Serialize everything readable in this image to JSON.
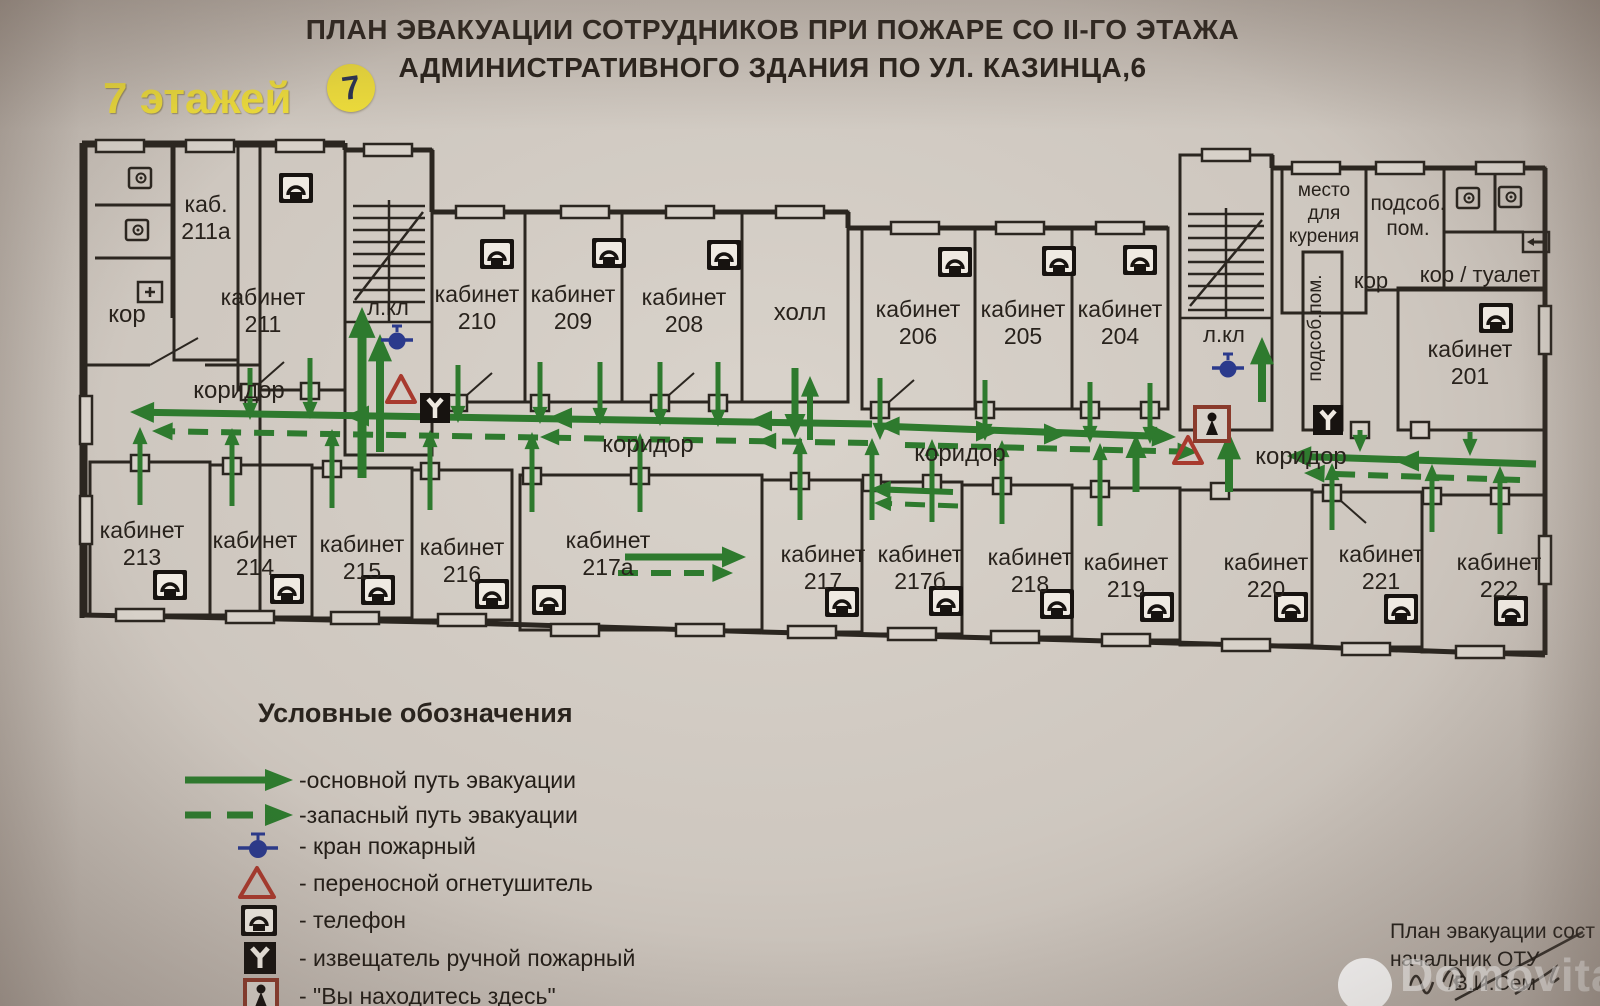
{
  "title": {
    "line1": "ПЛАН ЭВАКУАЦИИ СОТРУДНИКОВ  ПРИ ПОЖАРЕ СО II-ГО ЭТАЖА",
    "line2": "АДМИНИСТРАТИВНОГО ЗДАНИЯ ПО УЛ. КАЗИНЦА,6"
  },
  "floors": {
    "label": "7 этажей",
    "badge": "7"
  },
  "colors": {
    "wall": "#2b2620",
    "paper": "#d7d1c9",
    "green": "#2e7a2e",
    "red": "#a83a2e",
    "blue": "#2b3a8c",
    "black": "#171310",
    "here_box": "#8a3b2c",
    "yellow": "#f0df3a",
    "text": "#28221c"
  },
  "legend": {
    "title": "Условные обозначения",
    "items": [
      {
        "icon": "arrow-solid",
        "label": "-основной путь эвакуации"
      },
      {
        "icon": "arrow-dashed",
        "label": "-запасный путь эвакуации"
      },
      {
        "icon": "hydrant",
        "label": "- кран пожарный"
      },
      {
        "icon": "extinguisher",
        "label": "- переносной огнетушитель"
      },
      {
        "icon": "phone",
        "label": "- телефон"
      },
      {
        "icon": "alarm",
        "label": "- извещатель ручной пожарный"
      },
      {
        "icon": "you-are-here",
        "label": "- \"Вы находитесь здесь\""
      }
    ]
  },
  "footer": {
    "line1": "План эвакуации сост",
    "line2": "начальник ОТУ",
    "line3": "/В.И.Сем"
  },
  "watermark": {
    "text": "Domovita"
  },
  "plan": {
    "rooms": [
      [
        86,
        146,
        174,
        469
      ],
      [
        174,
        146,
        64,
        214
      ],
      [
        238,
        146,
        107,
        244
      ],
      [
        345,
        150,
        87,
        305
      ],
      [
        432,
        212,
        93,
        190
      ],
      [
        525,
        212,
        97,
        190
      ],
      [
        622,
        212,
        120,
        190
      ],
      [
        742,
        212,
        106,
        190
      ],
      [
        862,
        228,
        113,
        181
      ],
      [
        975,
        228,
        97,
        181
      ],
      [
        1072,
        228,
        96,
        181
      ],
      [
        1180,
        155,
        92,
        275
      ],
      [
        1282,
        168,
        84,
        145
      ],
      [
        1366,
        168,
        78,
        122
      ],
      [
        1303,
        252,
        39,
        178
      ],
      [
        1444,
        168,
        101,
        122
      ],
      [
        1398,
        288,
        147,
        142
      ],
      [
        90,
        462,
        120,
        153
      ],
      [
        210,
        465,
        102,
        152
      ],
      [
        312,
        468,
        100,
        150
      ],
      [
        412,
        470,
        100,
        150
      ],
      [
        520,
        475,
        242,
        155
      ],
      [
        762,
        480,
        100,
        152
      ],
      [
        862,
        482,
        100,
        152
      ],
      [
        962,
        485,
        110,
        152
      ],
      [
        1072,
        488,
        108,
        152
      ],
      [
        1180,
        490,
        132,
        155
      ],
      [
        1312,
        492,
        110,
        155
      ],
      [
        1422,
        495,
        123,
        157
      ]
    ],
    "outer": [
      [
        82,
        143,
        82,
        618
      ],
      [
        82,
        143,
        345,
        143
      ],
      [
        345,
        143,
        345,
        150
      ],
      [
        345,
        150,
        432,
        150
      ],
      [
        432,
        150,
        432,
        212
      ],
      [
        432,
        212,
        848,
        212
      ],
      [
        848,
        212,
        848,
        228
      ],
      [
        848,
        228,
        1168,
        228
      ],
      [
        1272,
        155,
        1272,
        168
      ],
      [
        1272,
        168,
        1282,
        168
      ],
      [
        1282,
        168,
        1545,
        168
      ],
      [
        1545,
        168,
        1545,
        655
      ],
      [
        82,
        615,
        432,
        622
      ],
      [
        432,
        622,
        762,
        632
      ],
      [
        762,
        632,
        1072,
        640
      ],
      [
        1072,
        640,
        1312,
        647
      ],
      [
        1312,
        647,
        1545,
        655
      ]
    ],
    "walls": [
      [
        95,
        205,
        172,
        205
      ],
      [
        95,
        258,
        172,
        258
      ],
      [
        172,
        146,
        172,
        318
      ],
      [
        86,
        365,
        150,
        365
      ],
      [
        205,
        365,
        260,
        365
      ],
      [
        1495,
        168,
        1495,
        232
      ],
      [
        1444,
        232,
        1524,
        232
      ],
      [
        150,
        365,
        198,
        338,
        2
      ],
      [
        250,
        392,
        284,
        362,
        2
      ],
      [
        458,
        403,
        492,
        373,
        2
      ],
      [
        660,
        403,
        694,
        373,
        2
      ],
      [
        880,
        410,
        914,
        380,
        2
      ],
      [
        1332,
        493,
        1366,
        523,
        2
      ]
    ],
    "stairs": [
      {
        "x1": 353,
        "x2": 425,
        "div": 389,
        "y": 206,
        "n": 8,
        "dy": 12,
        "diag": [
          355,
          300,
          423,
          212
        ],
        "divline": [
          389,
          200,
          389,
          322
        ],
        "land": [
          345,
          322,
          432,
          322
        ]
      },
      {
        "x1": 1188,
        "x2": 1264,
        "div": 1226,
        "y": 214,
        "n": 8,
        "dy": 12,
        "diag": [
          1190,
          306,
          1262,
          220
        ],
        "divline": [
          1226,
          208,
          1226,
          318
        ],
        "land": [
          1180,
          318,
          1272,
          318
        ]
      }
    ],
    "doors": [
      [
        250,
        392
      ],
      [
        310,
        391
      ],
      [
        458,
        403
      ],
      [
        540,
        403
      ],
      [
        660,
        403
      ],
      [
        718,
        403
      ],
      [
        880,
        410
      ],
      [
        985,
        410
      ],
      [
        1090,
        410
      ],
      [
        1150,
        410
      ],
      [
        140,
        463
      ],
      [
        232,
        466
      ],
      [
        332,
        469
      ],
      [
        430,
        471
      ],
      [
        532,
        476
      ],
      [
        640,
        476
      ],
      [
        800,
        481
      ],
      [
        872,
        483
      ],
      [
        932,
        483
      ],
      [
        1002,
        486
      ],
      [
        1100,
        489
      ],
      [
        1220,
        491
      ],
      [
        1332,
        493
      ],
      [
        1432,
        496
      ],
      [
        1500,
        496
      ],
      [
        1420,
        430
      ],
      [
        1360,
        430
      ]
    ],
    "bumps": [
      [
        120,
        146,
        "h"
      ],
      [
        210,
        146,
        "h"
      ],
      [
        300,
        146,
        "h"
      ],
      [
        388,
        150,
        "h"
      ],
      [
        480,
        212,
        "h"
      ],
      [
        585,
        212,
        "h"
      ],
      [
        690,
        212,
        "h"
      ],
      [
        800,
        212,
        "h"
      ],
      [
        915,
        228,
        "h"
      ],
      [
        1020,
        228,
        "h"
      ],
      [
        1120,
        228,
        "h"
      ],
      [
        1226,
        155,
        "h"
      ],
      [
        1316,
        168,
        "h"
      ],
      [
        1400,
        168,
        "h"
      ],
      [
        1500,
        168,
        "h"
      ],
      [
        140,
        615,
        "h"
      ],
      [
        250,
        617,
        "h"
      ],
      [
        355,
        618,
        "h"
      ],
      [
        462,
        620,
        "h"
      ],
      [
        575,
        630,
        "h"
      ],
      [
        700,
        630,
        "h"
      ],
      [
        812,
        632,
        "h"
      ],
      [
        912,
        634,
        "h"
      ],
      [
        1015,
        637,
        "h"
      ],
      [
        1126,
        640,
        "h"
      ],
      [
        1246,
        645,
        "h"
      ],
      [
        1366,
        649,
        "h"
      ],
      [
        1480,
        652,
        "h"
      ],
      [
        86,
        420,
        "v"
      ],
      [
        86,
        520,
        "v"
      ],
      [
        1545,
        330,
        "v"
      ],
      [
        1545,
        560,
        "v"
      ]
    ],
    "arrows": [
      {
        "p": [
          872,
          424,
          130,
          412
        ],
        "w": 7
      },
      {
        "p": [
          880,
          426,
          1176,
          437
        ],
        "w": 7
      },
      {
        "p": [
          1536,
          464,
          1287,
          456
        ],
        "w": 7
      },
      {
        "p": [
          868,
          443,
          152,
          431
        ],
        "w": 6,
        "d": 1
      },
      {
        "p": [
          905,
          445,
          1198,
          452
        ],
        "w": 6,
        "d": 1
      },
      {
        "p": [
          1520,
          480,
          1304,
          473
        ],
        "w": 6,
        "d": 1
      },
      {
        "p": [
          625,
          557,
          746,
          557
        ],
        "w": 7
      },
      {
        "p": [
          618,
          573,
          733,
          573
        ],
        "w": 6,
        "d": 1
      },
      {
        "p": [
          953,
          492,
          870,
          489
        ],
        "w": 6
      },
      {
        "p": [
          958,
          506,
          874,
          503
        ],
        "w": 5,
        "d": 1
      },
      {
        "p": [
          362,
          478,
          362,
          307
        ],
        "w": 9
      },
      {
        "p": [
          380,
          452,
          380,
          334
        ],
        "w": 8
      },
      {
        "p": [
          1262,
          402,
          1262,
          337
        ],
        "w": 8
      },
      {
        "p": [
          1229,
          492,
          1229,
          432
        ],
        "w": 8
      },
      {
        "p": [
          1136,
          492,
          1136,
          434
        ],
        "w": 7
      },
      {
        "p": [
          250,
          368,
          250,
          420
        ],
        "w": 5
      },
      {
        "p": [
          310,
          358,
          310,
          419
        ],
        "w": 5
      },
      {
        "p": [
          458,
          365,
          458,
          423
        ],
        "w": 5
      },
      {
        "p": [
          540,
          362,
          540,
          424
        ],
        "w": 5
      },
      {
        "p": [
          600,
          362,
          600,
          425
        ],
        "w": 5
      },
      {
        "p": [
          660,
          362,
          660,
          426
        ],
        "w": 5
      },
      {
        "p": [
          718,
          362,
          718,
          427
        ],
        "w": 5
      },
      {
        "p": [
          795,
          368,
          795,
          438
        ],
        "w": 7
      },
      {
        "p": [
          810,
          440,
          810,
          376
        ],
        "w": 6
      },
      {
        "p": [
          880,
          378,
          880,
          440
        ],
        "w": 5
      },
      {
        "p": [
          985,
          380,
          985,
          441
        ],
        "w": 5
      },
      {
        "p": [
          1090,
          382,
          1090,
          443
        ],
        "w": 5
      },
      {
        "p": [
          1150,
          383,
          1150,
          444
        ],
        "w": 5
      },
      {
        "p": [
          140,
          505,
          140,
          427
        ],
        "w": 5
      },
      {
        "p": [
          232,
          506,
          232,
          428
        ],
        "w": 5
      },
      {
        "p": [
          332,
          508,
          332,
          429
        ],
        "w": 5
      },
      {
        "p": [
          430,
          510,
          430,
          430
        ],
        "w": 5
      },
      {
        "p": [
          532,
          512,
          532,
          432
        ],
        "w": 5
      },
      {
        "p": [
          640,
          512,
          640,
          433
        ],
        "w": 5
      },
      {
        "p": [
          800,
          520,
          800,
          437
        ],
        "w": 5
      },
      {
        "p": [
          872,
          520,
          872,
          438
        ],
        "w": 5
      },
      {
        "p": [
          932,
          522,
          932,
          439
        ],
        "w": 5
      },
      {
        "p": [
          1002,
          524,
          1002,
          440
        ],
        "w": 5
      },
      {
        "p": [
          1100,
          526,
          1100,
          443
        ],
        "w": 5
      },
      {
        "p": [
          1332,
          530,
          1332,
          463
        ],
        "w": 5
      },
      {
        "p": [
          1432,
          532,
          1432,
          464
        ],
        "w": 5
      },
      {
        "p": [
          1500,
          534,
          1500,
          466
        ],
        "w": 5
      },
      {
        "p": [
          1360,
          430,
          1360,
          452
        ],
        "w": 5
      },
      {
        "p": [
          1470,
          432,
          1470,
          456
        ],
        "w": 5
      }
    ],
    "heads": [
      [
        345,
        416,
        "l",
        1
      ],
      [
        548,
        418,
        "l",
        1
      ],
      [
        748,
        421,
        "l",
        1
      ],
      [
        878,
        426,
        "l",
        0.9
      ],
      [
        540,
        437,
        "l",
        0.8
      ],
      [
        757,
        441,
        "l",
        0.8
      ],
      [
        1000,
        431,
        "r",
        1
      ],
      [
        1068,
        434,
        "r",
        1
      ],
      [
        1395,
        461,
        "l",
        1
      ]
    ],
    "icons": [
      [
        "phone",
        296,
        188
      ],
      [
        "phone",
        497,
        254
      ],
      [
        "phone",
        609,
        253
      ],
      [
        "phone",
        724,
        255
      ],
      [
        "phone",
        955,
        262
      ],
      [
        "phone",
        1059,
        261
      ],
      [
        "phone",
        1140,
        260
      ],
      [
        "phone",
        1496,
        318
      ],
      [
        "phone",
        170,
        585
      ],
      [
        "phone",
        287,
        589
      ],
      [
        "phone",
        378,
        590
      ],
      [
        "phone",
        492,
        594
      ],
      [
        "phone",
        549,
        600
      ],
      [
        "phone",
        842,
        602
      ],
      [
        "phone",
        946,
        601
      ],
      [
        "phone",
        1057,
        604
      ],
      [
        "phone",
        1157,
        607
      ],
      [
        "phone",
        1291,
        607
      ],
      [
        "phone",
        1401,
        609
      ],
      [
        "phone",
        1511,
        611
      ],
      [
        "hydrant",
        397,
        340
      ],
      [
        "hydrant",
        1228,
        368
      ],
      [
        "ext",
        401,
        391
      ],
      [
        "ext",
        1188,
        452
      ],
      [
        "alarm",
        435,
        408
      ],
      [
        "alarm",
        1328,
        420
      ],
      [
        "here",
        1212,
        424
      ],
      [
        "wc",
        140,
        178
      ],
      [
        "wc",
        137,
        230
      ],
      [
        "wc",
        1468,
        198
      ],
      [
        "wc",
        1510,
        197
      ],
      [
        "sinkplus",
        150,
        292
      ],
      [
        "exitbox",
        1536,
        242
      ]
    ],
    "labels": [
      [
        "кор",
        127,
        322,
        24
      ],
      [
        "каб.\n211а",
        206,
        212,
        23
      ],
      [
        "кабинет\n211",
        263,
        305,
        23
      ],
      [
        "л.кл",
        388,
        315,
        22
      ],
      [
        "кабинет\n210",
        477,
        302,
        23
      ],
      [
        "кабинет\n209",
        573,
        302,
        23
      ],
      [
        "кабинет\n208",
        684,
        305,
        23
      ],
      [
        "холл",
        800,
        320,
        24
      ],
      [
        "кабинет\n206",
        918,
        317,
        23
      ],
      [
        "кабинет\n205",
        1023,
        317,
        23
      ],
      [
        "кабинет\n204",
        1120,
        317,
        23
      ],
      [
        "л.кл",
        1224,
        342,
        22
      ],
      [
        "место\nдля\nкурения",
        1324,
        196,
        19
      ],
      [
        "подсоб.\nпом.",
        1408,
        210,
        21
      ],
      [
        "кор",
        1371,
        288,
        22
      ],
      [
        "кор / туалет",
        1480,
        282,
        22
      ],
      [
        "кабинет\n201",
        1470,
        357,
        23
      ],
      [
        "коридор",
        239,
        398,
        24
      ],
      [
        "коридор",
        648,
        452,
        24
      ],
      [
        "коридор",
        960,
        461,
        24
      ],
      [
        "коридор",
        1301,
        464,
        24
      ],
      [
        "кабинет\n213",
        142,
        538,
        23
      ],
      [
        "кабинет\n214",
        255,
        548,
        23
      ],
      [
        "кабинет\n215",
        362,
        552,
        23
      ],
      [
        "кабинет\n216",
        462,
        555,
        23
      ],
      [
        "кабинет\n217а",
        608,
        548,
        23
      ],
      [
        "кабинет\n217",
        823,
        562,
        23
      ],
      [
        "кабинет\n217б",
        920,
        562,
        23
      ],
      [
        "кабинет\n218",
        1030,
        565,
        23
      ],
      [
        "кабинет\n219",
        1126,
        570,
        23
      ],
      [
        "кабинет\n220",
        1266,
        570,
        23
      ],
      [
        "кабинет\n221",
        1381,
        562,
        23
      ],
      [
        "кабинет\n222",
        1499,
        570,
        23
      ]
    ],
    "vlabels": [
      [
        "подсоб.пом.",
        1321,
        328,
        19
      ]
    ]
  }
}
